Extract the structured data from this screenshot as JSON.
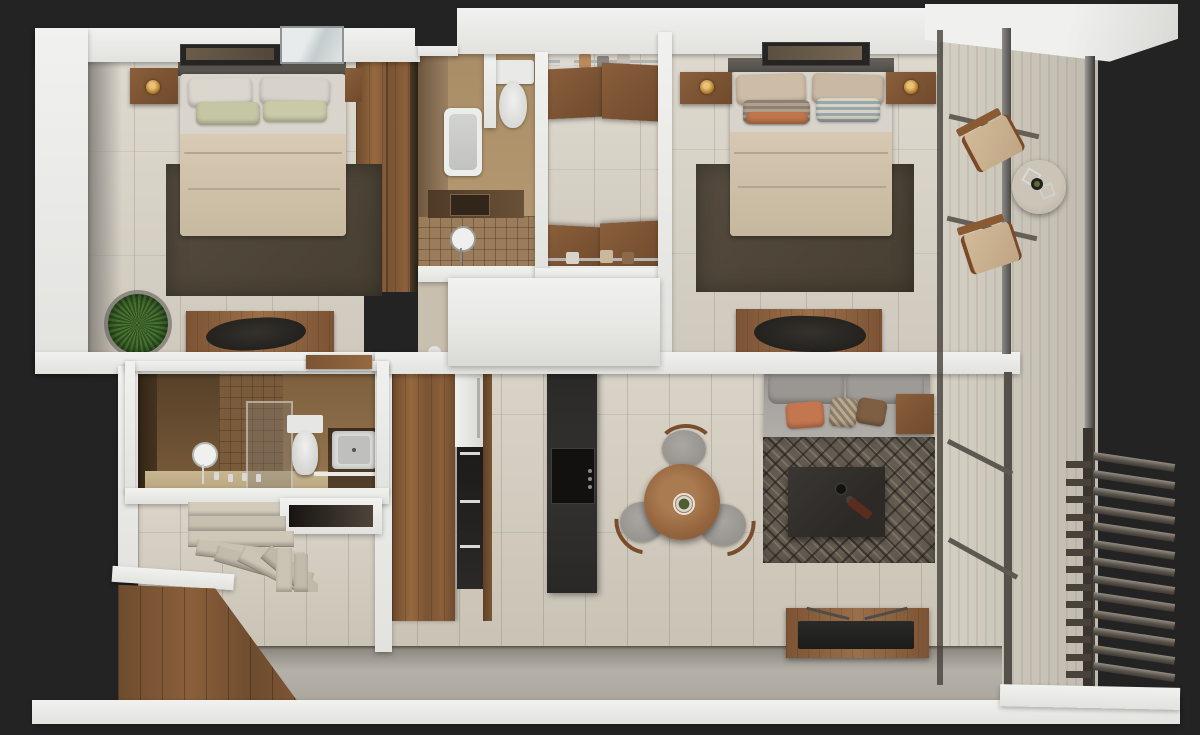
{
  "scene": {
    "type": "3d-floor-plan-render",
    "view": "top-down-cutaway",
    "background_color": "#232323",
    "rooms": [
      {
        "name": "bedroom-1",
        "position": "top-left",
        "furniture": [
          "double-bed",
          "white-pillows",
          "green-accent-pillows",
          "beige-duvet",
          "dark-area-rug",
          "nightstand-with-gold-lamp",
          "wall-art-frame",
          "window-skylight",
          "wardrobe",
          "desk",
          "black-desk-chair",
          "potted-plant"
        ]
      },
      {
        "name": "bathroom-1",
        "position": "top-middle",
        "furniture": [
          "bathtub",
          "toilet",
          "dark-wood-vanity",
          "walk-in-shower-tiled",
          "round-mirror"
        ]
      },
      {
        "name": "walk-in-closet",
        "position": "top-middle-right",
        "furniture": [
          "upper-wood-cabinets",
          "lower-wood-cabinets",
          "clothes-rails-with-hanging-clothes"
        ]
      },
      {
        "name": "bedroom-2",
        "position": "top-right",
        "furniture": [
          "double-bed",
          "beige-pillows",
          "striped-accent-pillows",
          "beige-duvet",
          "dark-area-rug",
          "nightstand-left-with-lamp",
          "nightstand-right-with-lamp",
          "wall-art-frame",
          "desk",
          "black-desk-chair"
        ]
      },
      {
        "name": "bathroom-2",
        "position": "middle-left",
        "furniture": [
          "walk-in-shower-glass",
          "toilet",
          "vanity-sink",
          "round-mirror-on-stand",
          "towel-shelf",
          "faucet-knobs"
        ]
      },
      {
        "name": "kitchen",
        "position": "bottom-middle-left",
        "furniture": [
          "wood-cabinet-run",
          "tall-appliance-column-white-and-black",
          "dark-stone-island",
          "four-burner-cooktop"
        ]
      },
      {
        "name": "dining-area",
        "position": "bottom-middle",
        "furniture": [
          "round-wood-table",
          "green-centerpiece",
          "three-gray-chairs-with-wood-arms"
        ]
      },
      {
        "name": "living-room",
        "position": "bottom-right",
        "furniture": [
          "gray-sofa",
          "orange-pillow",
          "patterned-pillow",
          "brown-pillow",
          "wood-side-table",
          "diamond-pattern-rug",
          "dark-coffee-table-with-decor",
          "wood-tv-console",
          "flat-tv"
        ]
      },
      {
        "name": "hallway-entry",
        "position": "bottom-left",
        "furniture": [
          "winder-stone-staircase",
          "wall-niche",
          "wood-clad-entry-wall"
        ]
      },
      {
        "name": "balcony",
        "position": "right",
        "furniture": [
          "lounge-chair-upper",
          "lounge-chair-lower",
          "round-side-table-with-plant",
          "glass-facade-mullions",
          "railing-bars",
          "louver-slat-screen"
        ]
      }
    ],
    "palette": {
      "background": "#232323",
      "wall_white": "#ebebe9",
      "floor_tile": "#d6cfc1",
      "bedroom_rug": "#4f4739",
      "living_rug": "#645c51",
      "wood_cabinet": "#8a5f3c",
      "wood_counter": "#96693f",
      "island_black": "#2b2927",
      "bathroom1_tan": "#b3976f",
      "bathroom2_brown": "#6e5335",
      "sofa_gray": "#a6a29e",
      "accent_orange": "#c0754d",
      "accent_green": "#c5c6a4",
      "accent_blue": "#98a7ad",
      "balcony_floor": "#cfc9bc",
      "slat_brown": "#55504a",
      "stair_stone": "#cbc4b5",
      "lamp_gold": "#c08a3e",
      "plant_green": "#4a7433",
      "glass_frame_dark": "#45413c"
    }
  }
}
